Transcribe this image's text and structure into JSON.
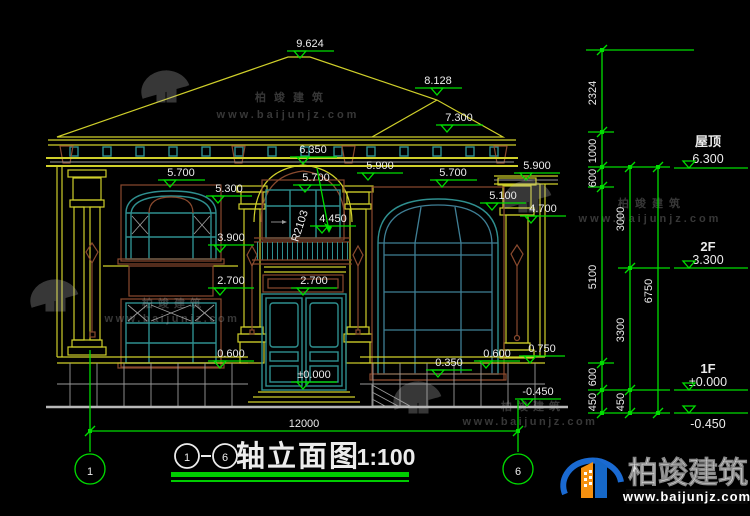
{
  "title": {
    "axis_from": "1",
    "axis_to": "6",
    "name": "轴立面图",
    "scale": "1:100"
  },
  "axes": {
    "left": "1",
    "right": "6"
  },
  "overall_dim": "12000",
  "levels": {
    "ridge": "9.624",
    "ridge2": "8.128",
    "roof_right": "7.300",
    "arch_top": "6.350",
    "eave_left": "5.700",
    "eave_center": "5.700",
    "eave_right": "5.700",
    "cornice_center": "5.900",
    "cornice_right": "5.900",
    "win_head_left": "5.300",
    "win_arch_right": "5.100",
    "capital_right": "4.700",
    "rail_top": "4.450",
    "radius": "R2103",
    "sill_2f_left": "3.900",
    "head_1f_left": "2.700",
    "door_head": "2.700",
    "sill_1f_left": "0.600",
    "sill_1f_right": "0.600",
    "plinth_right": "0.750",
    "entry": "±0.000",
    "sill_right_win": "0.350",
    "ground_right": "-0.450"
  },
  "chains": {
    "a": [
      "2324",
      "1000",
      "600",
      "5100",
      "600",
      "450"
    ],
    "b": [
      "3000",
      "3300",
      "450"
    ],
    "c": [
      "6750"
    ]
  },
  "floors": {
    "roof_label": "屋顶",
    "roof_value": "6.300",
    "f2_label": "2F",
    "f2_value": "3.300",
    "f1_label": "1F",
    "f1_value": "±0.000",
    "base_value": "-0.450"
  },
  "watermark": {
    "brand": "柏竣建筑",
    "url": "www.baijunjz.com"
  },
  "logo": {
    "brand": "柏竣建筑",
    "url": "www.baijunjz.com"
  }
}
